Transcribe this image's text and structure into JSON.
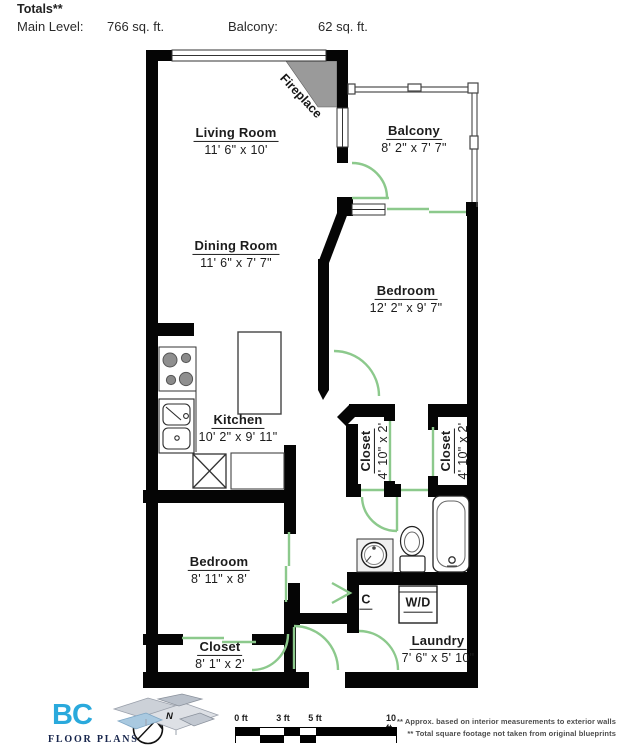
{
  "header": {
    "title": "Totals**",
    "main_level_label": "Main Level:",
    "main_level_value": "766 sq. ft.",
    "balcony_label": "Balcony:",
    "balcony_value": "62 sq. ft."
  },
  "rooms": {
    "living_room": {
      "name": "Living Room",
      "dims": "11' 6\" x 10'"
    },
    "balcony": {
      "name": "Balcony",
      "dims": "8' 2\" x 7' 7\""
    },
    "dining_room": {
      "name": "Dining Room",
      "dims": "11' 6\" x 7' 7\""
    },
    "bedroom_main": {
      "name": "Bedroom",
      "dims": "12' 2\" x 9' 7\""
    },
    "kitchen": {
      "name": "Kitchen",
      "dims": "10' 2\" x 9' 11\""
    },
    "closet_hall_left": {
      "name": "Closet",
      "dims": "4' 10\" x 2'"
    },
    "closet_hall_right": {
      "name": "Closet",
      "dims": "4' 10\" x 2'"
    },
    "bedroom_second": {
      "name": "Bedroom",
      "dims": "8' 11\" x 8'"
    },
    "closet_bedroom": {
      "name": "Closet",
      "dims": "8' 1\" x 2'"
    },
    "laundry": {
      "name": "Laundry",
      "dims": "7' 6\" x 5' 10\""
    },
    "fireplace_label": "Fireplace",
    "closet_c_label": "C",
    "washer_dryer_label": "W/D"
  },
  "scale_bar": {
    "tick0": "0 ft",
    "tick3": "3 ft",
    "tick5": "5 ft",
    "tick10": "10 ft"
  },
  "compass": {
    "north_label": "N"
  },
  "logo": {
    "brand": "BC",
    "subtitle": "FLOOR PLANS"
  },
  "notes": {
    "line1": "** Approx. based on interior measurements to exterior walls",
    "line2": "** Total square footage not taken from original blueprints"
  },
  "colors": {
    "wall": "#050505",
    "door_green": "#8cc98c",
    "fireplace_gray": "#9a9a9a",
    "brand_blue": "#2aa9dc",
    "logo_navy": "#17254c"
  }
}
